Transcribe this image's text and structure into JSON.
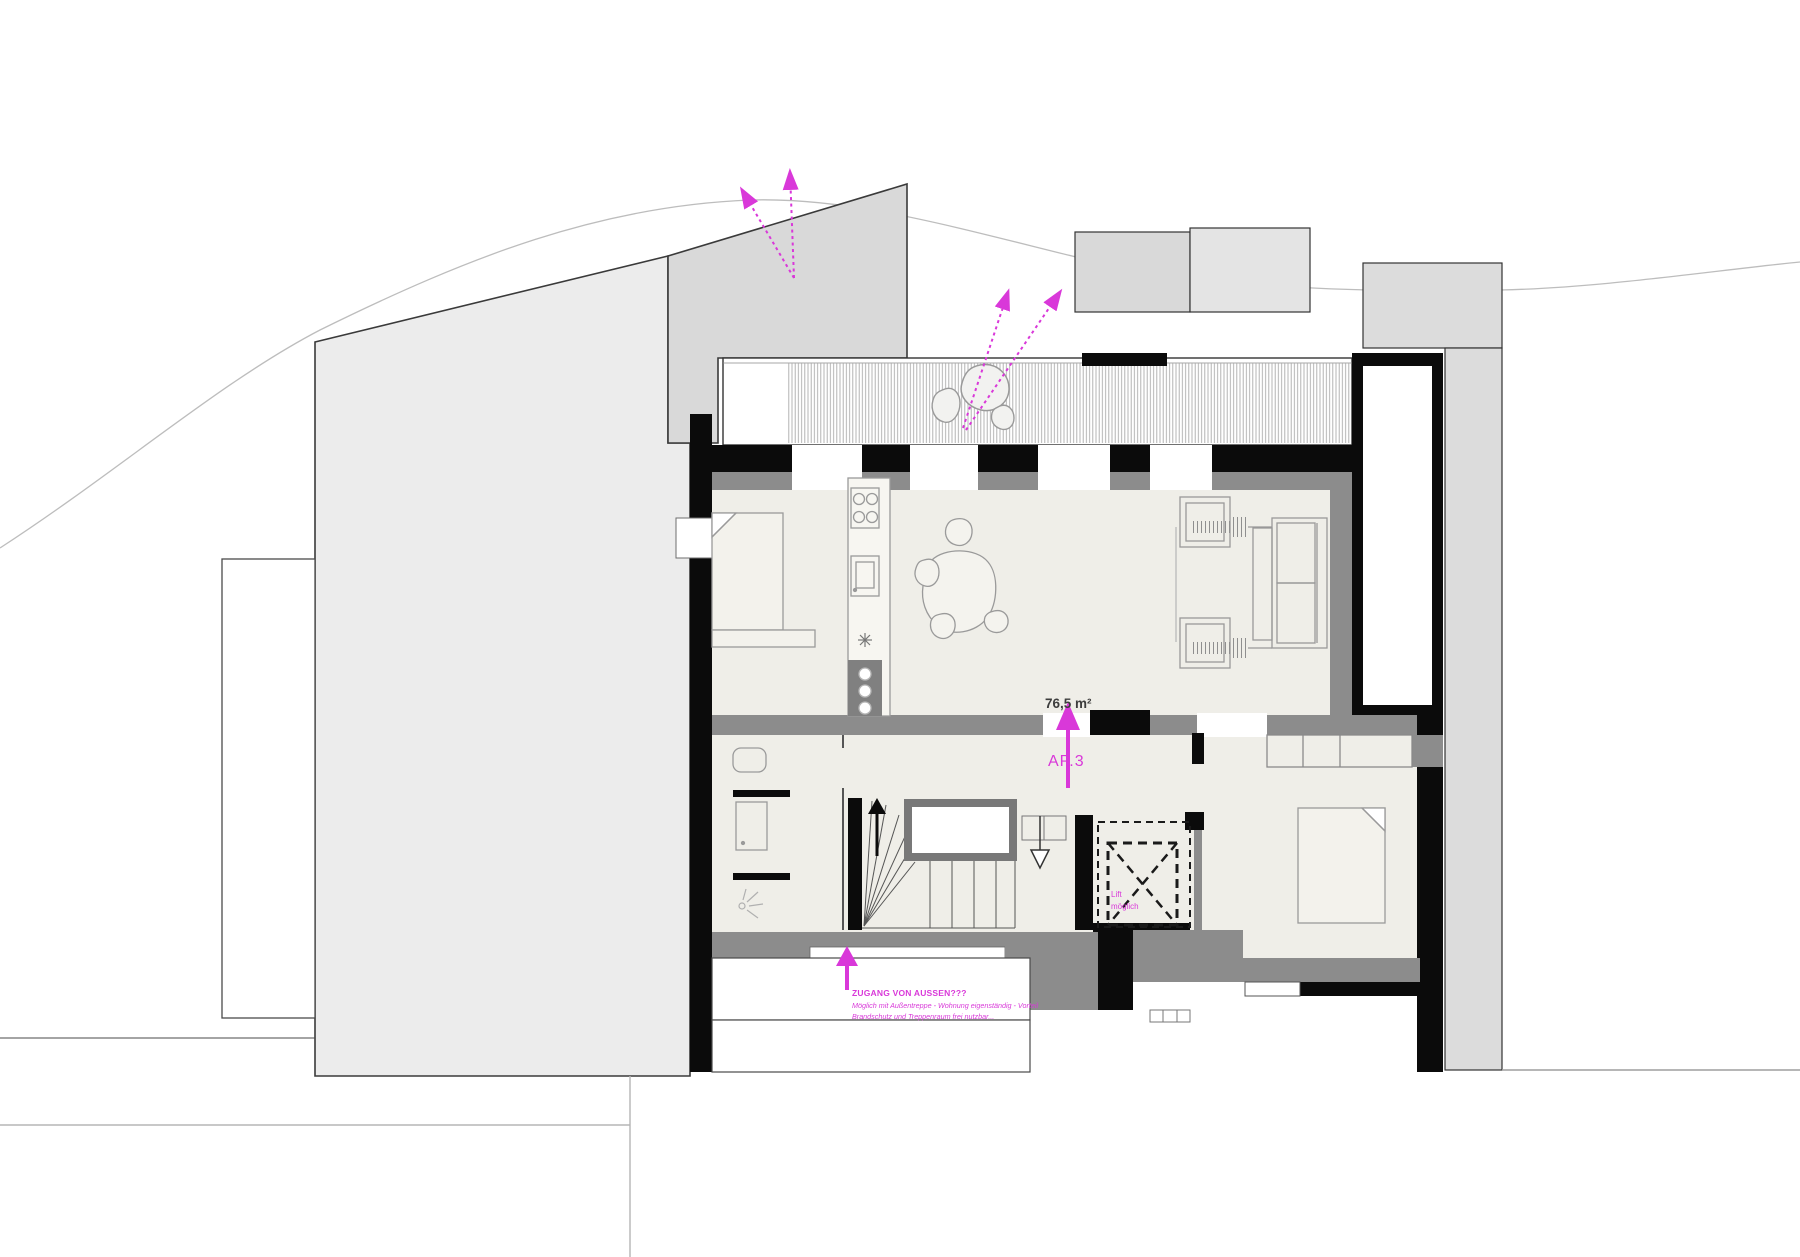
{
  "plan": {
    "apartment": {
      "area_label": "76,5 m²",
      "name_label": "AP.3"
    },
    "elevator_note": {
      "line1": "Lift",
      "line2": "möglich"
    },
    "entry_note": {
      "title": "ZUGANG VON AUSSEN???",
      "line2": "Möglich mit Außentreppe - Wohnung eigenständig - Vorteil",
      "line3": "Brandschutz und Treppenraum frei nutzbar...",
      "arrow_icon": "up-arrow"
    },
    "colors": {
      "annotation_magenta": "#d938d9",
      "wall_black": "#0b0b0b",
      "wall_gray": "#8c8c8c",
      "floor_beige": "#efeee8",
      "neighbor_gray": "#ececec",
      "wedge_gray": "#d9d9d9",
      "band_gray": "#dcdcdc"
    }
  }
}
